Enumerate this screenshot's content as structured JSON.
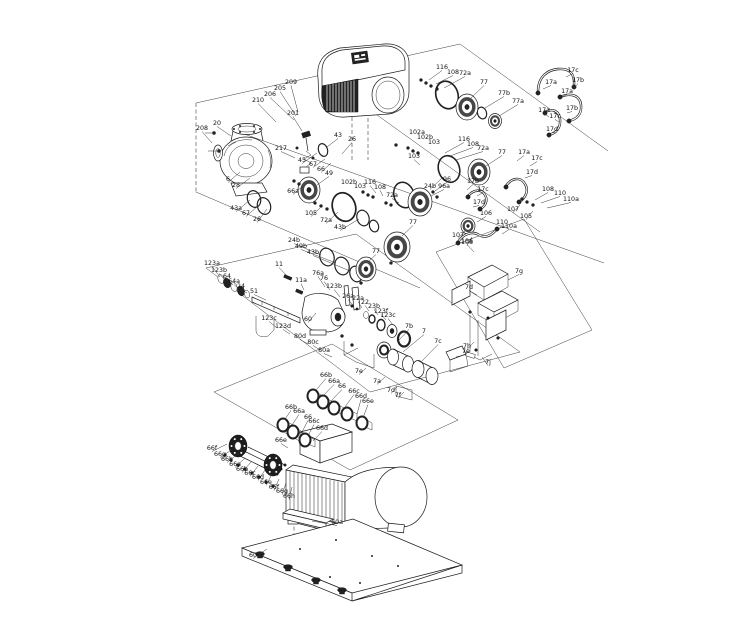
{
  "colors": {
    "background": "#ffffff",
    "line": "#1a1a1a",
    "label": "#111111"
  },
  "diagram": {
    "kind": "exploded-parts-diagram",
    "labels": [
      [
        "209",
        291,
        84,
        298,
        112
      ],
      [
        "205",
        280,
        90,
        296,
        116
      ],
      [
        "206",
        270,
        96,
        294,
        120
      ],
      [
        "210",
        258,
        102,
        276,
        122
      ],
      [
        "201",
        293,
        115,
        302,
        131
      ],
      [
        "20",
        217,
        125,
        231,
        136
      ],
      [
        "208",
        202,
        130,
        212,
        143
      ],
      [
        "217",
        281,
        150,
        295,
        158
      ],
      [
        "6",
        228,
        181,
        240,
        172
      ],
      [
        "28",
        236,
        187,
        250,
        178
      ],
      [
        "43",
        338,
        137,
        327,
        147
      ],
      [
        "26",
        352,
        141,
        342,
        154
      ],
      [
        "45",
        302,
        162,
        317,
        153
      ],
      [
        "67",
        313,
        166,
        325,
        159
      ],
      [
        "66",
        321,
        171,
        331,
        163
      ],
      [
        "49",
        329,
        175,
        317,
        185
      ],
      [
        "66a",
        293,
        193,
        303,
        186
      ],
      [
        "43a",
        236,
        210,
        250,
        200
      ],
      [
        "67",
        246,
        215,
        259,
        205
      ],
      [
        "26",
        257,
        221,
        267,
        209
      ],
      [
        "105",
        311,
        215,
        320,
        208
      ],
      [
        "72a",
        326,
        222,
        338,
        212
      ],
      [
        "43b",
        340,
        229,
        359,
        219
      ],
      [
        "24b",
        294,
        242,
        321,
        255
      ],
      [
        "49b",
        301,
        248,
        336,
        263
      ],
      [
        "43b",
        313,
        254,
        350,
        271
      ],
      [
        "102a",
        417,
        134,
        null,
        null
      ],
      [
        "102b",
        425,
        139,
        null,
        null
      ],
      [
        "103",
        434,
        144,
        null,
        null
      ],
      [
        "116",
        464,
        141,
        445,
        153
      ],
      [
        "108",
        473,
        146,
        450,
        156
      ],
      [
        "72a",
        483,
        150,
        456,
        160
      ],
      [
        "77",
        502,
        154,
        486,
        166
      ],
      [
        "103",
        414,
        158,
        420,
        165
      ],
      [
        "24b",
        430,
        188,
        443,
        177
      ],
      [
        "116",
        442,
        69,
        429,
        80
      ],
      [
        "108",
        453,
        74,
        436,
        84
      ],
      [
        "72a",
        465,
        75,
        444,
        88
      ],
      [
        "77",
        484,
        84,
        471,
        98
      ],
      [
        "77b",
        504,
        95,
        485,
        108
      ],
      [
        "77a",
        518,
        103,
        499,
        116
      ],
      [
        "17c",
        573,
        72,
        566,
        77
      ],
      [
        "17a",
        551,
        84,
        543,
        89
      ],
      [
        "17b",
        578,
        82,
        574,
        88
      ],
      [
        "17a",
        567,
        93,
        561,
        97
      ],
      [
        "17b",
        572,
        110,
        567,
        113
      ],
      [
        "17a",
        544,
        112,
        549,
        117
      ],
      [
        "17c",
        555,
        118,
        559,
        122
      ],
      [
        "17d",
        552,
        131,
        556,
        133
      ],
      [
        "17a",
        524,
        154,
        517,
        161
      ],
      [
        "17c",
        537,
        160,
        530,
        166
      ],
      [
        "17d",
        532,
        174,
        525,
        178
      ],
      [
        "102b",
        349,
        184,
        null,
        null
      ],
      [
        "103",
        360,
        188,
        null,
        null
      ],
      [
        "116",
        370,
        184,
        376,
        193
      ],
      [
        "108",
        380,
        189,
        383,
        196
      ],
      [
        "72a",
        392,
        197,
        399,
        203
      ],
      [
        "96",
        447,
        181,
        435,
        191
      ],
      [
        "96a",
        444,
        188,
        431,
        196
      ],
      [
        "77",
        413,
        224,
        402,
        236
      ],
      [
        "77",
        376,
        253,
        368,
        262
      ],
      [
        "17b",
        473,
        183,
        467,
        190
      ],
      [
        "17c",
        483,
        191,
        477,
        196
      ],
      [
        "17d",
        479,
        204,
        473,
        207
      ],
      [
        "106",
        486,
        215,
        477,
        222
      ],
      [
        "107",
        513,
        211,
        520,
        205
      ],
      [
        "105",
        526,
        218,
        533,
        211
      ],
      [
        "108",
        548,
        191,
        535,
        200
      ],
      [
        "110",
        560,
        195,
        541,
        203
      ],
      [
        "110a",
        571,
        201,
        547,
        208
      ],
      [
        "107",
        458,
        237,
        465,
        231
      ],
      [
        "108",
        467,
        244,
        472,
        237
      ],
      [
        "110",
        502,
        224,
        497,
        230
      ],
      [
        "110a",
        509,
        228,
        502,
        234
      ],
      [
        "123a",
        212,
        265,
        220,
        277
      ],
      [
        "123b",
        219,
        272,
        226,
        281
      ],
      [
        "64",
        227,
        278,
        233,
        285
      ],
      [
        "64a",
        234,
        283,
        239,
        289
      ],
      [
        "24",
        241,
        288,
        247,
        293
      ],
      [
        "51",
        254,
        293,
        266,
        300
      ],
      [
        "11",
        279,
        266,
        287,
        276
      ],
      [
        "11a",
        301,
        282,
        304,
        290
      ],
      [
        "76a",
        318,
        275,
        325,
        287
      ],
      [
        "76",
        324,
        280,
        330,
        290
      ],
      [
        "123b",
        334,
        288,
        340,
        297
      ],
      [
        "26a",
        348,
        298,
        354,
        306
      ],
      [
        "22a",
        358,
        300,
        362,
        308
      ],
      [
        "22",
        365,
        304,
        369,
        311
      ],
      [
        "23b",
        374,
        308,
        378,
        315
      ],
      [
        "123f",
        381,
        313,
        386,
        320
      ],
      [
        "123c",
        388,
        317,
        393,
        325
      ],
      [
        "123c",
        269,
        320,
        276,
        327
      ],
      [
        "123d",
        283,
        328,
        290,
        334
      ],
      [
        "60",
        308,
        321,
        316,
        313
      ],
      [
        "80d",
        300,
        338,
        308,
        344
      ],
      [
        "80c",
        313,
        344,
        320,
        350
      ],
      [
        "80a",
        324,
        352,
        332,
        357
      ],
      [
        "106",
        467,
        243,
        474,
        252
      ],
      [
        "7g",
        519,
        273,
        508,
        280
      ],
      [
        "7d",
        469,
        289,
        477,
        295
      ],
      [
        "7h",
        467,
        348,
        474,
        342
      ],
      [
        "7j",
        488,
        364,
        482,
        357
      ],
      [
        "7b",
        409,
        328,
        398,
        341
      ],
      [
        "7",
        424,
        333,
        403,
        352
      ],
      [
        "7c",
        438,
        343,
        421,
        362
      ],
      [
        "7e",
        466,
        353,
        456,
        357
      ],
      [
        "7e",
        359,
        373,
        366,
        368
      ],
      [
        "7a",
        377,
        383,
        385,
        377
      ],
      [
        "7d",
        391,
        392,
        397,
        387
      ],
      [
        "7f",
        398,
        397,
        404,
        392
      ],
      [
        "66b",
        326,
        377,
        316,
        390
      ],
      [
        "66a",
        334,
        383,
        323,
        396
      ],
      [
        "66",
        342,
        388,
        331,
        401
      ],
      [
        "66c",
        354,
        393,
        345,
        407
      ],
      [
        "66d",
        361,
        398,
        357,
        414
      ],
      [
        "66e",
        368,
        403,
        363,
        418
      ],
      [
        "66b",
        291,
        409,
        285,
        419
      ],
      [
        "66a",
        299,
        413,
        292,
        425
      ],
      [
        "66",
        308,
        419,
        302,
        432
      ],
      [
        "66c",
        314,
        423,
        308,
        436
      ],
      [
        "66d",
        322,
        430,
        313,
        441
      ],
      [
        "66e",
        281,
        442,
        288,
        448
      ],
      [
        "66f",
        212,
        450,
        227,
        444
      ],
      [
        "66g",
        220,
        456,
        233,
        449
      ],
      [
        "66h",
        227,
        461,
        239,
        453
      ],
      [
        "66a",
        235,
        466,
        245,
        458
      ],
      [
        "66b",
        242,
        471,
        251,
        462
      ],
      [
        "66c",
        250,
        475,
        258,
        466
      ],
      [
        "66d",
        258,
        479,
        265,
        470
      ],
      [
        "66e",
        266,
        484,
        272,
        474
      ],
      [
        "66f",
        274,
        489,
        279,
        479
      ],
      [
        "66g",
        282,
        493,
        286,
        483
      ],
      [
        "66h",
        289,
        498,
        292,
        487
      ],
      [
        "60a",
        337,
        524,
        312,
        521
      ],
      [
        "60",
        253,
        557,
        267,
        549
      ]
    ]
  }
}
